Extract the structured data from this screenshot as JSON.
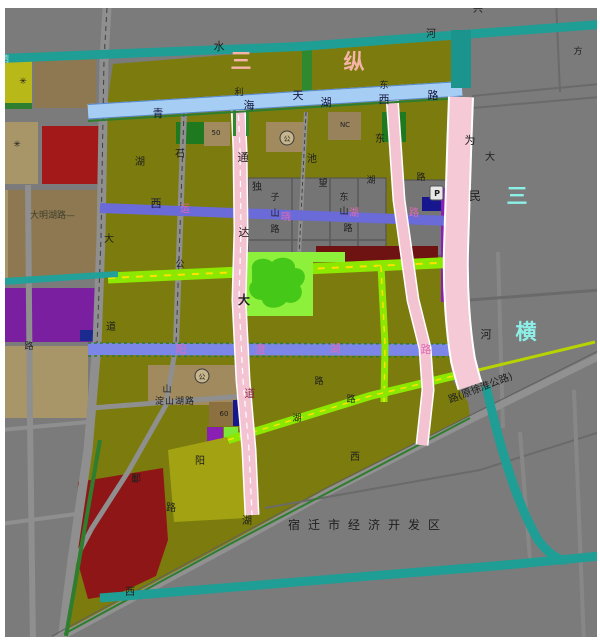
{
  "palette": {
    "background": "#7b7b7b",
    "olive_parcel": "#7c7c0e",
    "river_teal": "#1f9e96",
    "road_blue_major": "#a6cdf4",
    "road_blue_secondary": "#6a6ad8",
    "road_blue_third": "#7b86e8",
    "road_lime": "#8ce800",
    "road_pink": "#f4c3d1",
    "park_green": "#8df03a",
    "red_parcel": "#a31818",
    "purple_parcel": "#8a1fb4",
    "brown_parcel": "#8d7852",
    "corridor_text_pink": "#f6b3a7",
    "corridor_text_cyan": "#8df0e8",
    "road_label_pink": "#e06ab8"
  },
  "corridors": {
    "vertical_chars": [
      "三",
      "纵"
    ],
    "horizontal_chars": [
      "三",
      "横"
    ]
  },
  "region_label": "宿迁市经济开发区",
  "labels": [
    {
      "t": "水"
    },
    {
      "t": "河"
    },
    {
      "t": "兴"
    },
    {
      "t": "方"
    },
    {
      "t": "三"
    },
    {
      "t": "纵"
    },
    {
      "t": "清"
    },
    {
      "t": "青"
    },
    {
      "t": "海"
    },
    {
      "t": "利"
    },
    {
      "t": "天"
    },
    {
      "t": "湖"
    },
    {
      "t": "西"
    },
    {
      "t": "路"
    },
    {
      "t": "东"
    },
    {
      "t": "东"
    },
    {
      "t": "石"
    },
    {
      "t": "池"
    },
    {
      "t": "独"
    },
    {
      "t": "子"
    },
    {
      "t": "山"
    },
    {
      "t": "路"
    },
    {
      "t": "望"
    },
    {
      "t": "东"
    },
    {
      "t": "山"
    },
    {
      "t": "路"
    },
    {
      "t": "湖"
    },
    {
      "t": "路"
    },
    {
      "t": "西"
    },
    {
      "t": "运"
    },
    {
      "t": "晓"
    },
    {
      "t": "湖"
    },
    {
      "t": "路"
    },
    {
      "t": "通"
    },
    {
      "t": "达"
    },
    {
      "t": "大"
    },
    {
      "t": "道"
    },
    {
      "t": "为"
    },
    {
      "t": "大"
    },
    {
      "t": "民"
    },
    {
      "t": "河"
    },
    {
      "t": "三"
    },
    {
      "t": "横"
    },
    {
      "t": "大"
    },
    {
      "t": "道"
    },
    {
      "t": "路"
    },
    {
      "t": "湖"
    },
    {
      "t": "大明湖路—"
    },
    {
      "t": "公"
    },
    {
      "t": "阳"
    },
    {
      "t": "澄"
    },
    {
      "t": "湖"
    },
    {
      "t": "路"
    },
    {
      "t": "50"
    },
    {
      "t": "60"
    },
    {
      "t": "NC"
    },
    {
      "t": "P"
    },
    {
      "t": "山"
    },
    {
      "t": "淀山湖路"
    },
    {
      "t": "路"
    },
    {
      "t": "路"
    },
    {
      "t": "湖"
    },
    {
      "t": "阳"
    },
    {
      "t": "鄱"
    },
    {
      "t": "路"
    },
    {
      "t": "湖"
    },
    {
      "t": "西"
    },
    {
      "t": "西"
    },
    {
      "t": "宿迁市经济开发区"
    },
    {
      "t": "路(原徐淮公路)"
    },
    {
      "t": "公"
    },
    {
      "t": "公"
    },
    {
      "t": "✳"
    },
    {
      "t": "✳"
    }
  ]
}
